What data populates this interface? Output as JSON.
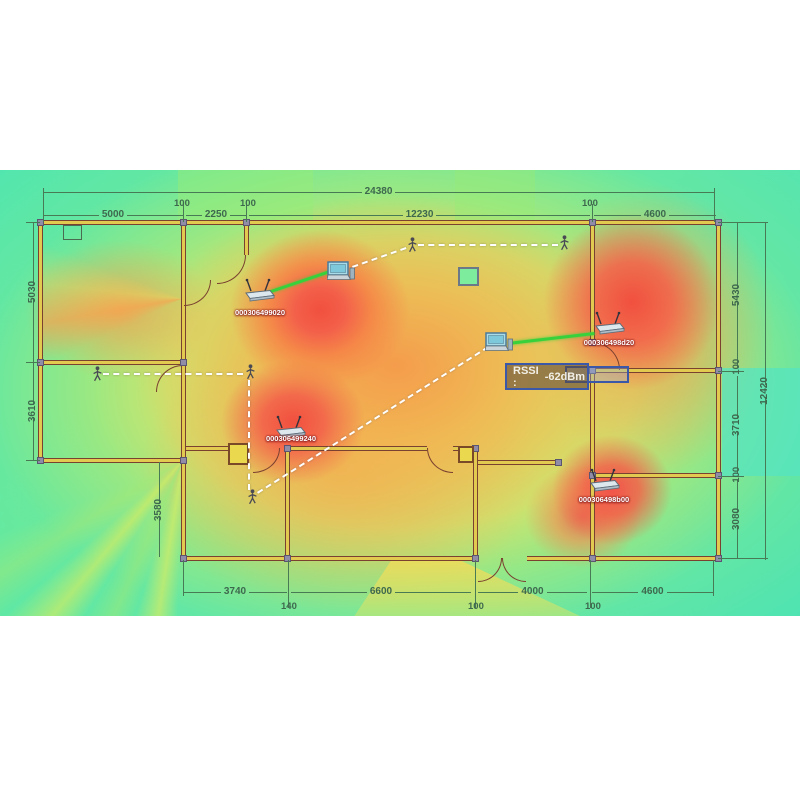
{
  "map": {
    "tooltip": {
      "label": "RSSI :",
      "value": "-62dBm"
    },
    "access_points": [
      {
        "id": "ap-1",
        "mac": "000306499020"
      },
      {
        "id": "ap-2",
        "mac": "000306498d20"
      },
      {
        "id": "ap-3",
        "mac": "000306498b00"
      },
      {
        "id": "ap-4",
        "mac": "000306499240"
      }
    ],
    "dimensions": {
      "total_width": "24380",
      "total_height": "12420",
      "top": [
        "5000",
        "100",
        "2250",
        "100",
        "12230",
        "100",
        "4600"
      ],
      "left": [
        "5030",
        "3610"
      ],
      "left_inner": "3580",
      "right": [
        "5430",
        "100",
        "3710",
        "100",
        "3080"
      ],
      "bottom": [
        "3740",
        "140",
        "6600",
        "100",
        "4000",
        "100",
        "4600"
      ]
    },
    "heat_colors": {
      "strong": "#f1503f",
      "good": "#f5a04e",
      "fair": "#eddc58",
      "weak": "#8cea84",
      "none": "#48e2b2",
      "link": "#38d13c",
      "selection": "#3a57a8"
    }
  }
}
